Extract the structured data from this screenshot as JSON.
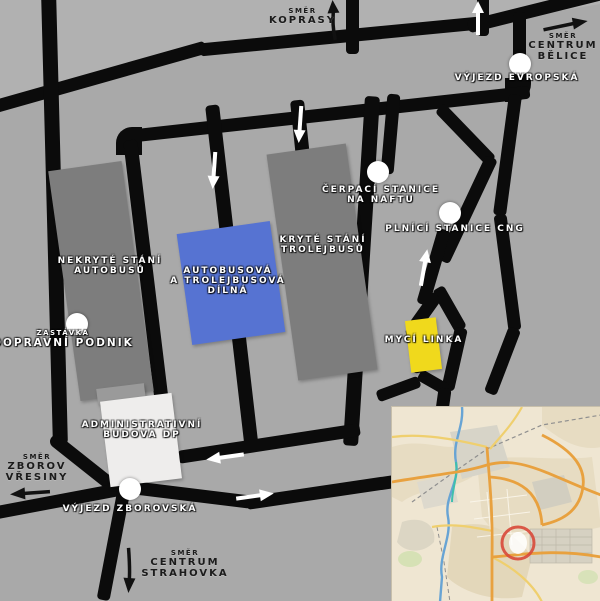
{
  "colors": {
    "background": "#a9a9a9",
    "background_light": "#b4b4b4",
    "road": "#0b0b0b",
    "building_gray": "#7d7d7d",
    "building_blue": "#5673d2",
    "building_yellow": "#f0d91c",
    "building_white": "#eeedec",
    "marker_white": "#ffffff",
    "inset_bg": "#efe6d2",
    "inset_road_major": "#e8a13f",
    "inset_road_minor": "#efcf6e",
    "inset_river": "#68a4d4",
    "inset_ring": "#d8493a"
  },
  "signs": {
    "koprasy": {
      "small": "SMĚR",
      "lines": [
        "KOPRASY"
      ]
    },
    "belice": {
      "small": "SMĚR",
      "lines": [
        "CENTRUM",
        "BĚLICE"
      ]
    },
    "vresiny": {
      "small": "SMĚR",
      "lines": [
        "ZBOROV",
        "VŘESINY"
      ]
    },
    "strahovka": {
      "small": "SMĚR",
      "lines": [
        "CENTRUM",
        "STRAHOVKA"
      ]
    }
  },
  "stations": {
    "evropska": {
      "label": "VÝJEZD EVROPSKÁ"
    },
    "cerpaci": {
      "lines": [
        "ČERPACÍ STANICE",
        "NA NAFTU"
      ]
    },
    "cng": {
      "label": "PLNÍCÍ STANICE CNG"
    },
    "zastavka": {
      "small": "ZASTÁVKA",
      "label": "DOPRAVNÍ PODNIK"
    },
    "zborovska": {
      "label": "VÝJEZD ZBOROVSKÁ"
    }
  },
  "buildings": {
    "nekryte": {
      "lines": [
        "NEKRYTÉ STÁNÍ",
        "AUTOBUSŮ"
      ]
    },
    "kryte": {
      "lines": [
        "KRYTÉ STÁNÍ",
        "TROLEJBUSŮ"
      ]
    },
    "dilna": {
      "lines": [
        "AUTOBUSOVÁ",
        "A TROLEJBUSOVÁ",
        "DÍLNÁ"
      ]
    },
    "myci": {
      "label": "MYCÍ LINKA"
    },
    "admin": {
      "lines": [
        "ADMINISTRATIVNÍ",
        "BUDOVA DP"
      ]
    }
  }
}
